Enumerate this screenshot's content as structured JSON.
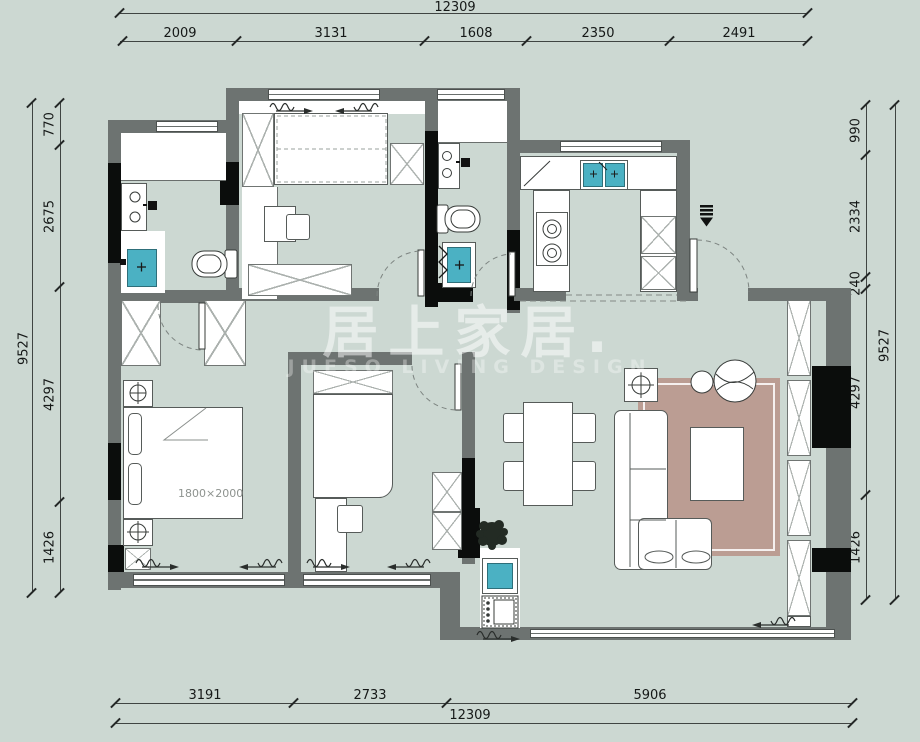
{
  "watermark": {
    "title": "居上家居.",
    "subtitle": "JUESO LIVING DESIGN"
  },
  "dims": {
    "top": {
      "total": "12309",
      "segments": [
        "2009",
        "3131",
        "1608",
        "2350",
        "2491"
      ]
    },
    "left": {
      "total": "9527",
      "segments": [
        "770",
        "2675",
        "4297",
        "1426"
      ]
    },
    "right": {
      "total": "9527",
      "segments": [
        "990",
        "2334",
        "240",
        "4297",
        "1426"
      ]
    },
    "bottom": {
      "total": "12309",
      "segments": [
        "3191",
        "2733",
        "5906"
      ]
    }
  },
  "labels": {
    "bed_size": "1800×2000"
  },
  "colors": {
    "background": "#ccd8d2",
    "wall_gray": "#6d7371",
    "wall_black": "#0b0d0c",
    "fixture_teal": "#4bb1c3",
    "rug_pink": "#bb9d93",
    "dimension_text": "#151817",
    "watermark_white": "#ffffff"
  }
}
